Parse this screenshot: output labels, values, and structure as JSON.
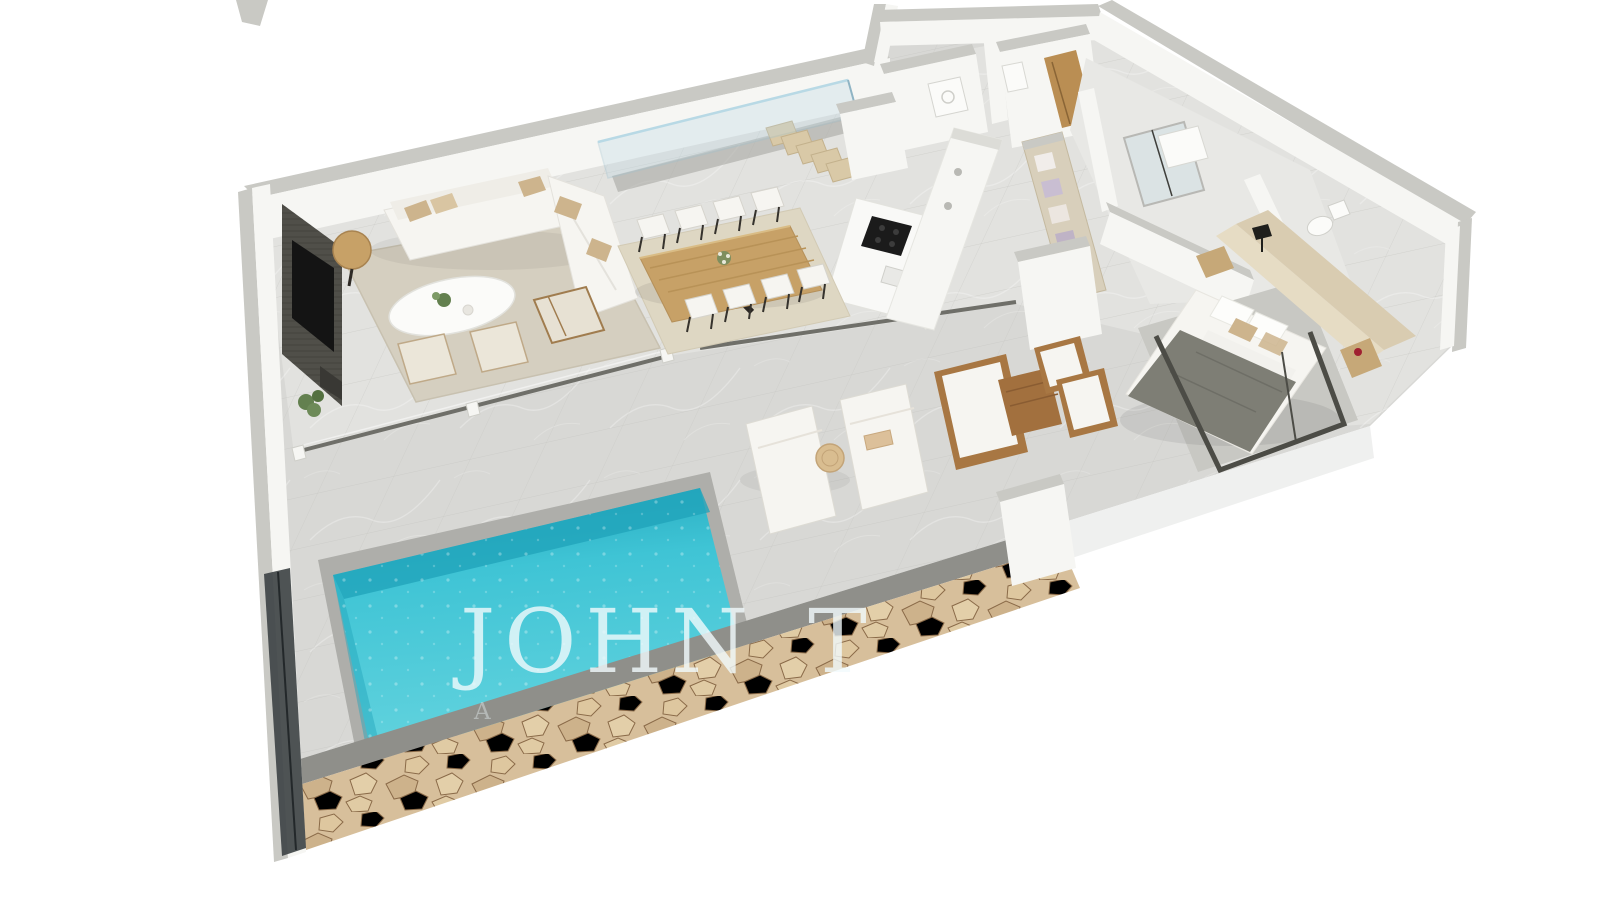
{
  "watermark": {
    "title": "JOHN T",
    "tagline": "A"
  },
  "colors": {
    "bg": "#ffffff",
    "floor": "#d8d8d5",
    "interiorFloor": "#e2e2df",
    "tileLine": "#c4c4c0",
    "wallFace": "#f6f6f3",
    "wallCap": "#c9c9c4",
    "fascia": "#eff0ef",
    "coping": "#8f8f8a",
    "stone": "#d7bf9b",
    "stoneCrack": "#8a6a48",
    "poolLight": "#63d3de",
    "pool": "#3fc4d5",
    "poolDeep": "#21a4ba",
    "rugLiving": "#d5cfc0",
    "rugDining": "#ded7c3",
    "rugBedroom": "#c8c8c3",
    "woodTable": "#c7a167",
    "outdoorWood": "#a87743",
    "charcoal": "#504f49",
    "tv": "#141414",
    "cushion": "#f6f5f1",
    "pillowTan": "#cdb48d",
    "headboard": "#d9ccb1",
    "blanket": "#7e7e75",
    "doorWood": "#ba8e53",
    "glassLine": "#6f6f69",
    "glassFill": "#bdd8e4",
    "basin": "#fbfbf9",
    "greenery": "#63804f",
    "flowerRed": "#a02030",
    "watermark": "#f2fbfd"
  }
}
